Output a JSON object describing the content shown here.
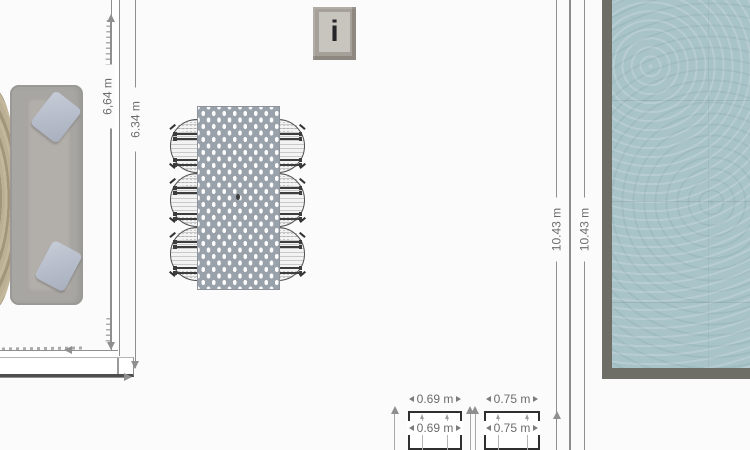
{
  "canvas": {
    "background": "#fbfbfb"
  },
  "dimensions": {
    "sofa_wall_inner": "6,64 m",
    "sofa_wall_outer": "6.34 m",
    "pool_wall_inner": "10.43 m",
    "pool_wall_outer": "10.43 m",
    "box1_top": "0.69 m",
    "box1_inner": "0.69 m",
    "box2_top": "0.75 m",
    "box2_inner": "0.75 m"
  },
  "wall_sign": {
    "glyph": "i"
  },
  "colors": {
    "pool_water": "#a9c4c8",
    "pool_border": "#6e6e66",
    "table": "#99a1aa",
    "sofa": "#a8a6a2",
    "pillow": "#b7bdc9",
    "wall_line": "#8f8f8f",
    "dimension_text": "#6c6c6c",
    "sign_frame": "#a5a098",
    "sign_panel": "#c8c5bf",
    "box_border": "#2f2f2f"
  }
}
